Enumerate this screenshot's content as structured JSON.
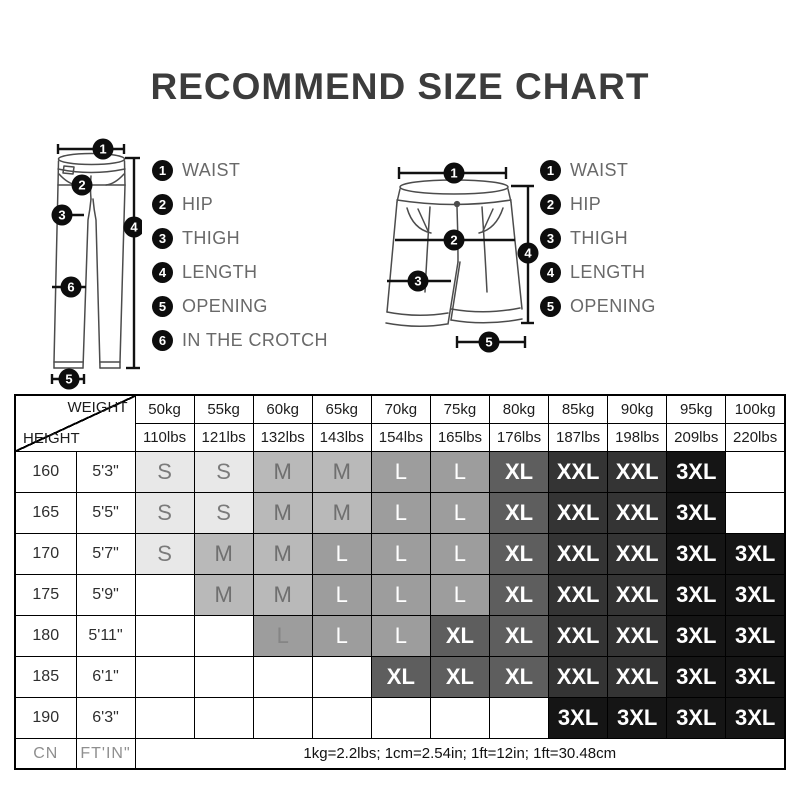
{
  "title": "RECOMMEND SIZE CHART",
  "pants_diagram": {
    "callouts": [
      "1",
      "2",
      "3",
      "4",
      "5",
      "6"
    ],
    "legend": [
      {
        "num": "1",
        "label": "WAIST"
      },
      {
        "num": "2",
        "label": "HIP"
      },
      {
        "num": "3",
        "label": "THIGH"
      },
      {
        "num": "4",
        "label": "LENGTH"
      },
      {
        "num": "5",
        "label": "OPENING"
      },
      {
        "num": "6",
        "label": "IN THE CROTCH"
      }
    ]
  },
  "shorts_diagram": {
    "callouts": [
      "1",
      "2",
      "3",
      "4",
      "5"
    ],
    "legend": [
      {
        "num": "1",
        "label": "WAIST"
      },
      {
        "num": "2",
        "label": "HIP"
      },
      {
        "num": "3",
        "label": "THIGH"
      },
      {
        "num": "4",
        "label": "LENGTH"
      },
      {
        "num": "5",
        "label": "OPENING"
      }
    ]
  },
  "chart_data": {
    "type": "table",
    "title": "RECOMMEND SIZE CHART",
    "corner": {
      "top": "WEIGHT",
      "bottom": "HEIGHT"
    },
    "weights_kg": [
      "50kg",
      "55kg",
      "60kg",
      "65kg",
      "70kg",
      "75kg",
      "80kg",
      "85kg",
      "90kg",
      "95kg",
      "100kg"
    ],
    "weights_lbs": [
      "110lbs",
      "121lbs",
      "132lbs",
      "143lbs",
      "154lbs",
      "165lbs",
      "176lbs",
      "187lbs",
      "198lbs",
      "209lbs",
      "220lbs"
    ],
    "rows": [
      {
        "height_cn": "160",
        "height_ftin": "5'3\"",
        "sizes": [
          "S",
          "S",
          "M",
          "M",
          "L",
          "L",
          "XL",
          "XXL",
          "XXL",
          "3XL",
          ""
        ]
      },
      {
        "height_cn": "165",
        "height_ftin": "5'5\"",
        "sizes": [
          "S",
          "S",
          "M",
          "M",
          "L",
          "L",
          "XL",
          "XXL",
          "XXL",
          "3XL",
          ""
        ]
      },
      {
        "height_cn": "170",
        "height_ftin": "5'7\"",
        "sizes": [
          "S",
          "M",
          "M",
          "L",
          "L",
          "L",
          "XL",
          "XXL",
          "XXL",
          "3XL",
          "3XL"
        ]
      },
      {
        "height_cn": "175",
        "height_ftin": "5'9\"",
        "sizes": [
          "",
          "M",
          "M",
          "L",
          "L",
          "L",
          "XL",
          "XXL",
          "XXL",
          "3XL",
          "3XL"
        ]
      },
      {
        "height_cn": "180",
        "height_ftin": "5'11\"",
        "sizes": [
          "",
          "",
          "L*",
          "L",
          "L",
          "XL",
          "XL",
          "XXL",
          "XXL",
          "3XL",
          "3XL"
        ]
      },
      {
        "height_cn": "185",
        "height_ftin": "6'1\"",
        "sizes": [
          "",
          "",
          "",
          "",
          "XL",
          "XL",
          "XL",
          "XXL",
          "XXL",
          "3XL",
          "3XL"
        ]
      },
      {
        "height_cn": "190",
        "height_ftin": "6'3\"",
        "sizes": [
          "",
          "",
          "",
          "",
          "",
          "",
          "",
          "3XL",
          "3XL",
          "3XL",
          "3XL"
        ]
      }
    ],
    "footer": {
      "height_unit": "CN",
      "ftin_unit": "FT'IN\"",
      "note": "1kg=2.2lbs; 1cm=2.54in; 1ft=12in; 1ft=30.48cm"
    },
    "size_colors": {
      "S": "#e8e8e8",
      "M": "#b9b9b9",
      "L": "#9d9d9d",
      "XL": "#5e5e5e",
      "XXL": "#343434",
      "3XL": "#151515"
    }
  }
}
